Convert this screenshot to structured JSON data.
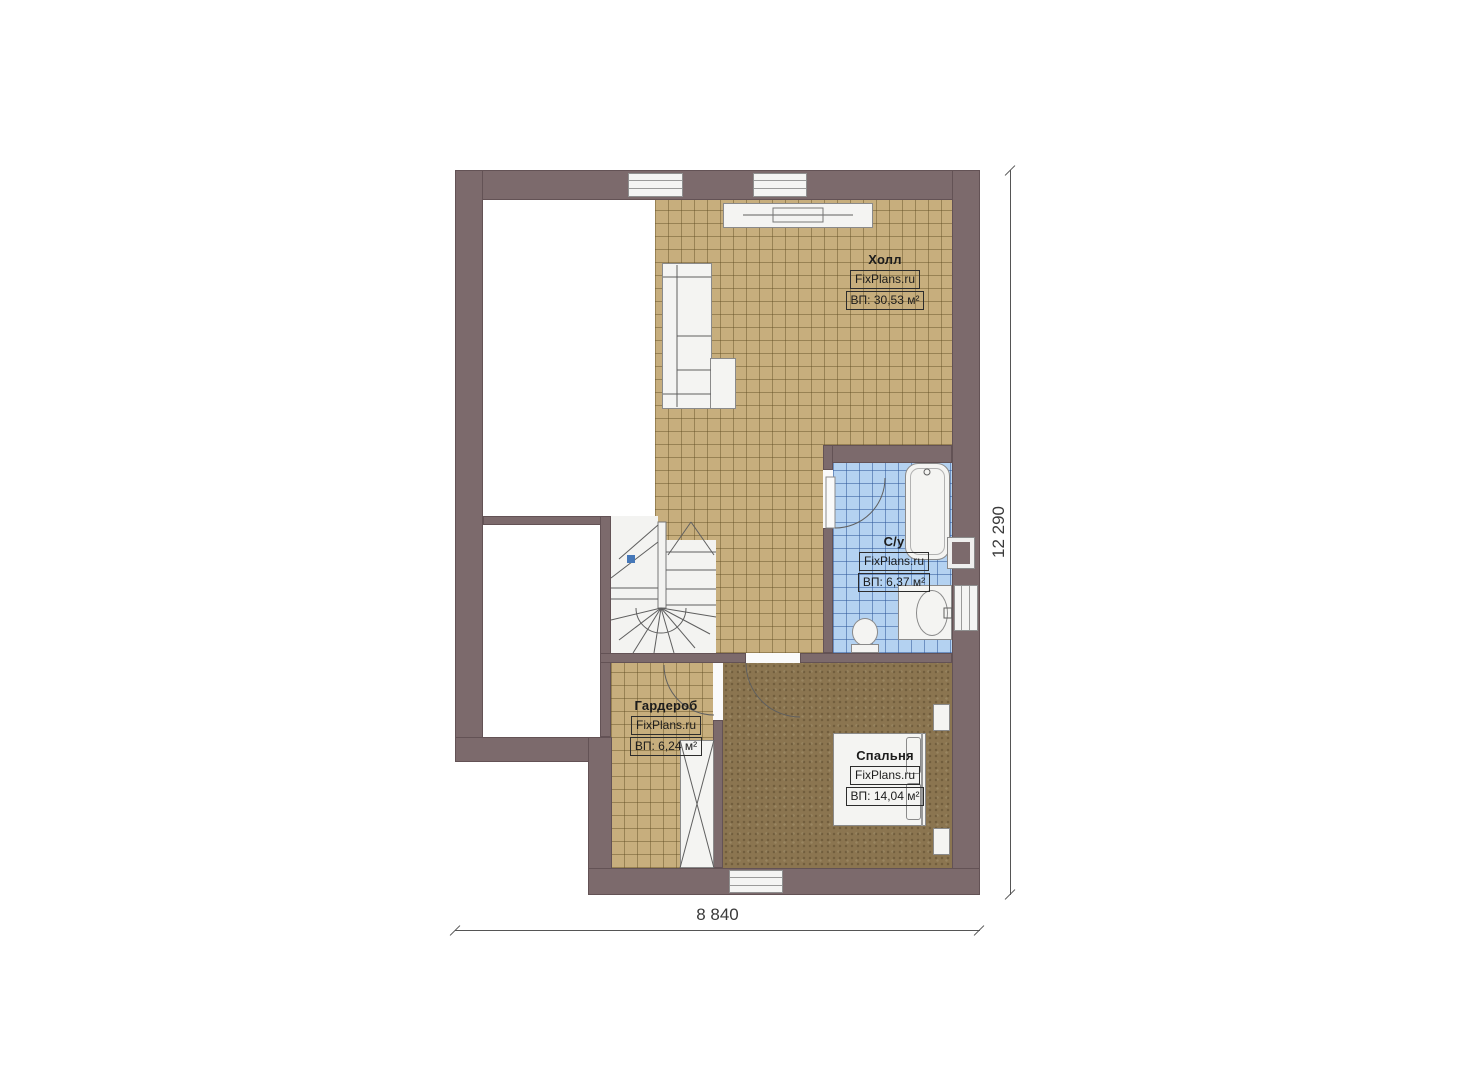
{
  "rooms": {
    "hall": {
      "name": "Холл",
      "watermark": "FixPlans.ru",
      "area": "ВП: 30,53 м²"
    },
    "bathroom": {
      "name": "С/у",
      "watermark": "FixPlans.ru",
      "area": "ВП: 6,37 м²"
    },
    "wardrobe": {
      "name": "Гардероб",
      "watermark": "FixPlans.ru",
      "area": "ВП: 6,24 м²"
    },
    "bedroom": {
      "name": "Спальня",
      "watermark": "FixPlans.ru",
      "area": "ВП: 14,04 м²"
    }
  },
  "dimensions": {
    "width_label": "8 840",
    "height_label": "12 290"
  },
  "colors": {
    "wall": "#7c6a6c",
    "hall_floor": "#c7ae7d",
    "bathroom_floor": "#b4d2f1",
    "bedroom_floor": "#8b7550",
    "furniture": "#f4f4f2",
    "stair_marker": "#4577b8"
  }
}
